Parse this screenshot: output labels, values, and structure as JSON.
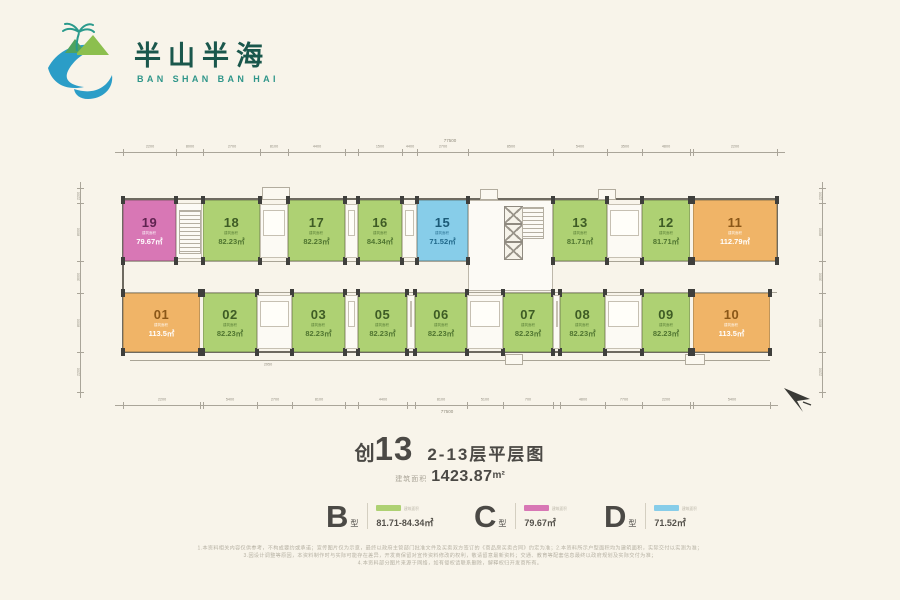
{
  "page": {
    "bg_color": "#f8f4ea"
  },
  "logo": {
    "cn_title": "半山半海",
    "en_title": "BAN SHAN BAN HAI",
    "colors": {
      "wave": "#2b9dc7",
      "mountain_light": "#8cbf4e",
      "mountain_dark": "#4ea35f",
      "palm": "#2a9a8c",
      "cn_text": "#1a574c",
      "en_text": "#2f968a"
    }
  },
  "plan": {
    "area_prefix": "建筑面积",
    "type_colors": {
      "B": {
        "fill": "#aed173",
        "num": "#3e5c25",
        "area_text": "#4f7430"
      },
      "C": {
        "fill": "#d877b5",
        "num": "#5f2350",
        "area_text": "#ffffff"
      },
      "D": {
        "fill": "#87cde9",
        "num": "#1b5a77",
        "area_text": "#20688a"
      },
      "A": {
        "fill": "#f0b467",
        "num": "#8a5718",
        "area_text": "#ffffff"
      }
    },
    "top_row": [
      {
        "id": "19",
        "area": "79.67㎡",
        "type": "C",
        "x": 123,
        "w": 53
      },
      {
        "id": "18",
        "area": "82.23㎡",
        "type": "B",
        "x": 203,
        "w": 57
      },
      {
        "id": "17",
        "area": "82.23㎡",
        "type": "B",
        "x": 288,
        "w": 57
      },
      {
        "id": "16",
        "area": "84.34㎡",
        "type": "B",
        "x": 358,
        "w": 44
      },
      {
        "id": "15",
        "area": "71.52㎡",
        "type": "D",
        "x": 417,
        "w": 51
      },
      {
        "id": "13",
        "area": "81.71㎡",
        "type": "B",
        "x": 553,
        "w": 54
      },
      {
        "id": "12",
        "area": "81.71㎡",
        "type": "B",
        "x": 642,
        "w": 48
      },
      {
        "id": "11",
        "area": "112.79㎡",
        "type": "A",
        "x": 693,
        "w": 84
      }
    ],
    "bottom_row": [
      {
        "id": "01",
        "area": "113.5㎡",
        "type": "A",
        "x": 123,
        "w": 77
      },
      {
        "id": "02",
        "area": "82.23㎡",
        "type": "B",
        "x": 203,
        "w": 54
      },
      {
        "id": "03",
        "area": "82.23㎡",
        "type": "B",
        "x": 292,
        "w": 53
      },
      {
        "id": "05",
        "area": "82.23㎡",
        "type": "B",
        "x": 358,
        "w": 49
      },
      {
        "id": "06",
        "area": "82.23㎡",
        "type": "B",
        "x": 415,
        "w": 52
      },
      {
        "id": "07",
        "area": "82.23㎡",
        "type": "B",
        "x": 503,
        "w": 50
      },
      {
        "id": "08",
        "area": "82.23㎡",
        "type": "B",
        "x": 560,
        "w": 45
      },
      {
        "id": "09",
        "area": "82.23㎡",
        "type": "B",
        "x": 642,
        "w": 48
      },
      {
        "id": "10",
        "area": "113.5㎡",
        "type": "A",
        "x": 693,
        "w": 77
      }
    ],
    "slots_top": [
      {
        "x": 260,
        "w": 28
      },
      {
        "x": 345,
        "w": 13
      },
      {
        "x": 402,
        "w": 15
      },
      {
        "x": 607,
        "w": 35
      }
    ],
    "slots_bottom": [
      {
        "x": 257,
        "w": 35
      },
      {
        "x": 345,
        "w": 13
      },
      {
        "x": 407,
        "w": 8
      },
      {
        "x": 467,
        "w": 36
      },
      {
        "x": 553,
        "w": 7
      },
      {
        "x": 605,
        "w": 37
      }
    ],
    "dims": {
      "top_total": "77500",
      "bottom_total": "77500",
      "top_segments": [
        "2200",
        "8000",
        "2700",
        "8100",
        "4400",
        "8100",
        "1500",
        "4400",
        "2700",
        "8500",
        "5400",
        "3500",
        "4800",
        "8400"
      ],
      "bottom_segments": [
        "2200",
        "8000",
        "5400",
        "2700",
        "8100",
        "1300",
        "4400",
        "3600",
        "8100",
        "5100",
        "700",
        "3700",
        "4800",
        "7700"
      ],
      "left_segments": [
        "2200",
        "8000",
        "3000",
        "8000",
        "2200"
      ],
      "right_segments": [
        "2200",
        "8000",
        "3000",
        "8000",
        "2200"
      ],
      "side_label": "2950"
    }
  },
  "title": {
    "prefix": "创",
    "big": "13",
    "rest": "2-13层平层图",
    "area_label": "建筑面积",
    "area_value": "1423.87",
    "area_unit": "m²"
  },
  "legend": {
    "items": [
      {
        "letter": "B",
        "kind": "型",
        "color": "#aed173",
        "note": "建筑面积",
        "value": "81.71-84.34㎡"
      },
      {
        "letter": "C",
        "kind": "型",
        "color": "#d877b5",
        "note": "建筑面积",
        "value": "79.67㎡"
      },
      {
        "letter": "D",
        "kind": "型",
        "color": "#87cde9",
        "note": "建筑面积",
        "value": "71.52㎡"
      }
    ]
  },
  "disclaimer": [
    "1.本资料相关内容仅供参考，不构成要约或承诺；宣传图片仅为示意，最终以政府主管部门批准文件及买卖双方签订的《商品房买卖合同》约定为准；2.本资料所示户型面积均为建筑面积，实际交付以实测为准；",
    "3.因设计调整等原因，本资料制作时与实际可能存在差异，开发商保留对宣传资料修改的权利，敬请留意最新资料；交通、教育等配套信息最终以政府规划及实际交付为准；",
    "4.本资料部分图片来源于网络，如有侵权请联系删除，解释权归开发商所有。"
  ]
}
